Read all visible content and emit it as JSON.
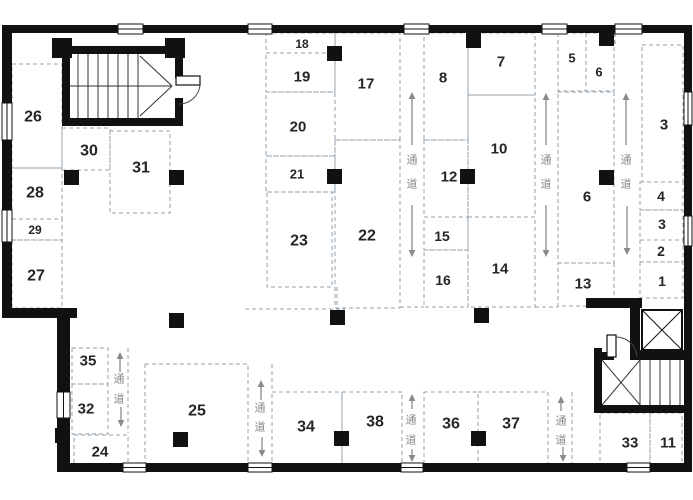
{
  "page": {
    "kind": "architectural-floor-plan",
    "language": "zh",
    "background": "#ffffff"
  },
  "plan": {
    "canvas": {
      "w": 693,
      "h": 500
    },
    "colors": {
      "wall": "#111111",
      "dash": "#93a1ad",
      "label": "#262626",
      "corridor_text": "#8a8a8a",
      "arrow": "#8a8a8a",
      "stair_line": "#333333",
      "bg": "#ffffff"
    },
    "corridor_label": "通道",
    "rooms": [
      {
        "name": "room-26",
        "label": "26",
        "box": [
          12,
          64,
          50,
          104
        ],
        "lp": [
          33,
          117
        ],
        "fs": 16
      },
      {
        "name": "room-30",
        "label": "30",
        "box": [
          62,
          128,
          48,
          42
        ],
        "lp": [
          89,
          151
        ],
        "fs": 16
      },
      {
        "name": "room-31",
        "label": "31",
        "box": [
          110,
          131,
          60,
          82
        ],
        "lp": [
          141,
          168
        ],
        "fs": 16
      },
      {
        "name": "room-28",
        "label": "28",
        "box": [
          12,
          168,
          50,
          51
        ],
        "lp": [
          35,
          193
        ],
        "fs": 16
      },
      {
        "name": "room-29",
        "label": "29",
        "box": [
          12,
          219,
          50,
          21
        ],
        "lp": [
          35,
          230
        ],
        "fs": 12
      },
      {
        "name": "room-27",
        "label": "27",
        "box": [
          12,
          240,
          50,
          68
        ],
        "lp": [
          36,
          276
        ],
        "fs": 16
      },
      {
        "name": "room-18",
        "label": "18",
        "box": [
          266,
          33,
          69,
          20
        ],
        "lp": [
          302,
          44
        ],
        "fs": 12
      },
      {
        "name": "room-19",
        "label": "19",
        "box": [
          266,
          53,
          69,
          39
        ],
        "lp": [
          302,
          77
        ],
        "fs": 15
      },
      {
        "name": "room-20",
        "label": "20",
        "box": [
          266,
          92,
          69,
          64
        ],
        "lp": [
          298,
          127
        ],
        "fs": 15
      },
      {
        "name": "room-21",
        "label": "21",
        "box": [
          266,
          156,
          69,
          36
        ],
        "lp": [
          297,
          174
        ],
        "fs": 13
      },
      {
        "name": "room-23",
        "label": "23",
        "box": [
          267,
          192,
          65,
          95
        ],
        "lp": [
          299,
          241
        ],
        "fs": 16
      },
      {
        "name": "room-17",
        "label": "17",
        "box": [
          335,
          33,
          65,
          107
        ],
        "lp": [
          366,
          84
        ],
        "fs": 15
      },
      {
        "name": "room-22",
        "label": "22",
        "box": [
          335,
          140,
          65,
          168
        ],
        "lp": [
          367,
          236
        ],
        "fs": 16
      },
      {
        "name": "room-8",
        "label": "8",
        "box": [
          424,
          33,
          44,
          107
        ],
        "lp": [
          443,
          78
        ],
        "fs": 15
      },
      {
        "name": "room-12",
        "label": "12",
        "box": [
          424,
          140,
          44,
          77
        ],
        "lp": [
          449,
          177
        ],
        "fs": 15
      },
      {
        "name": "room-15",
        "label": "15",
        "box": [
          424,
          217,
          44,
          33
        ],
        "lp": [
          442,
          236
        ],
        "fs": 14
      },
      {
        "name": "room-16",
        "label": "16",
        "box": [
          424,
          250,
          44,
          57
        ],
        "lp": [
          443,
          280
        ],
        "fs": 14
      },
      {
        "name": "room-7",
        "label": "7",
        "box": [
          468,
          33,
          67,
          62
        ],
        "lp": [
          501,
          62
        ],
        "fs": 15
      },
      {
        "name": "room-10",
        "label": "10",
        "box": [
          468,
          95,
          67,
          122
        ],
        "lp": [
          499,
          149
        ],
        "fs": 15
      },
      {
        "name": "room-14",
        "label": "14",
        "box": [
          468,
          217,
          67,
          90
        ],
        "lp": [
          500,
          269
        ],
        "fs": 15
      },
      {
        "name": "room-5",
        "label": "5",
        "box": [
          558,
          33,
          28,
          58
        ],
        "lp": [
          572,
          58
        ],
        "fs": 13
      },
      {
        "name": "room-6-small",
        "label": "6",
        "box": [
          586,
          33,
          28,
          58
        ],
        "lp": [
          599,
          72
        ],
        "fs": 13
      },
      {
        "name": "room-6",
        "label": "6",
        "box": [
          558,
          92,
          56,
          171
        ],
        "lp": [
          587,
          197
        ],
        "fs": 15
      },
      {
        "name": "room-13",
        "label": "13",
        "box": [
          558,
          263,
          56,
          43
        ],
        "lp": [
          583,
          284
        ],
        "fs": 15
      },
      {
        "name": "room-3",
        "label": "3",
        "box": [
          642,
          45,
          41,
          137
        ],
        "lp": [
          664,
          125
        ],
        "fs": 15
      },
      {
        "name": "room-4",
        "label": "4",
        "box": [
          640,
          182,
          43,
          28
        ],
        "lp": [
          661,
          196
        ],
        "fs": 14
      },
      {
        "name": "room-3-small",
        "label": "3",
        "box": [
          640,
          210,
          43,
          30
        ],
        "lp": [
          662,
          224
        ],
        "fs": 14
      },
      {
        "name": "room-2",
        "label": "2",
        "box": [
          640,
          240,
          43,
          22
        ],
        "lp": [
          661,
          251
        ],
        "fs": 14
      },
      {
        "name": "room-1",
        "label": "1",
        "box": [
          640,
          262,
          43,
          36
        ],
        "lp": [
          662,
          281
        ],
        "fs": 14
      },
      {
        "name": "room-35",
        "label": "35",
        "box": [
          72,
          348,
          36,
          36
        ],
        "lp": [
          88,
          361
        ],
        "fs": 15
      },
      {
        "name": "room-32",
        "label": "32",
        "box": [
          72,
          384,
          36,
          50
        ],
        "lp": [
          86,
          409
        ],
        "fs": 15
      },
      {
        "name": "room-24",
        "label": "24",
        "box": [
          74,
          435,
          54,
          30
        ],
        "lp": [
          100,
          452
        ],
        "fs": 15
      },
      {
        "name": "room-25",
        "label": "25",
        "box": [
          145,
          364,
          103,
          102
        ],
        "lp": [
          197,
          411
        ],
        "fs": 16
      },
      {
        "name": "room-34",
        "label": "34",
        "box": [
          272,
          392,
          70,
          73
        ],
        "lp": [
          306,
          427
        ],
        "fs": 16
      },
      {
        "name": "room-38",
        "label": "38",
        "box": [
          342,
          392,
          60,
          73
        ],
        "lp": [
          375,
          422
        ],
        "fs": 16
      },
      {
        "name": "room-36",
        "label": "36",
        "box": [
          424,
          392,
          54,
          73
        ],
        "lp": [
          451,
          424
        ],
        "fs": 16
      },
      {
        "name": "room-37",
        "label": "37",
        "box": [
          478,
          392,
          70,
          73
        ],
        "lp": [
          511,
          424
        ],
        "fs": 16
      },
      {
        "name": "room-33",
        "label": "33",
        "box": [
          600,
          413,
          50,
          51
        ],
        "lp": [
          630,
          443
        ],
        "fs": 15
      },
      {
        "name": "room-11",
        "label": "11",
        "box": [
          650,
          413,
          32,
          51
        ],
        "lp": [
          668,
          443
        ],
        "fs": 15
      }
    ],
    "corridors": [
      {
        "name": "corridor-upper-1",
        "label": "通道",
        "chars": [
          [
            412,
            160
          ],
          [
            412,
            184
          ]
        ],
        "up": [
          412,
          92,
          145
        ],
        "down": [
          412,
          205,
          257
        ],
        "lines": []
      },
      {
        "name": "corridor-upper-2",
        "label": "通道",
        "chars": [
          [
            546,
            160
          ],
          [
            546,
            184
          ]
        ],
        "up": [
          546,
          93,
          145
        ],
        "down": [
          546,
          205,
          257
        ],
        "lines": []
      },
      {
        "name": "corridor-upper-3",
        "label": "通道",
        "chars": [
          [
            626,
            160
          ],
          [
            626,
            184
          ]
        ],
        "up": [
          626,
          93,
          145
        ],
        "down": [
          627,
          206,
          255
        ],
        "lines": [
          [
            615,
            33,
            45
          ]
        ]
      },
      {
        "name": "corridor-lower-1",
        "label": "通道",
        "chars": [
          [
            119,
            379
          ],
          [
            119,
            399
          ]
        ],
        "up": [
          120,
          352,
          372
        ],
        "down": [
          121,
          407,
          427
        ],
        "lines": [
          [
            128,
            348,
            433
          ]
        ]
      },
      {
        "name": "corridor-lower-2",
        "label": "通道",
        "chars": [
          [
            260,
            408
          ],
          [
            260,
            427
          ]
        ],
        "up": [
          261,
          380,
          400
        ],
        "down": [
          262,
          437,
          457
        ],
        "lines": [
          [
            272,
            364,
            392
          ]
        ]
      },
      {
        "name": "corridor-lower-3",
        "label": "通道",
        "chars": [
          [
            411,
            420
          ],
          [
            411,
            440
          ]
        ],
        "up": [
          412,
          394,
          409
        ],
        "down": [
          412,
          449,
          462
        ],
        "lines": []
      },
      {
        "name": "corridor-lower-4",
        "label": "通道",
        "chars": [
          [
            561,
            421
          ],
          [
            561,
            440
          ]
        ],
        "up": [
          561,
          396,
          411
        ],
        "down": [
          563,
          447,
          462
        ],
        "lines": [
          [
            572,
            392,
            463
          ]
        ]
      }
    ],
    "extra_dashes": [
      [
        245,
        309,
        345,
        309
      ],
      [
        400,
        307,
        424,
        307
      ],
      [
        535,
        307,
        558,
        307
      ],
      [
        337,
        287,
        337,
        309
      ]
    ],
    "walls": [
      {
        "n": "wall-top",
        "r": [
          2,
          25,
          688,
          8
        ]
      },
      {
        "n": "wall-left",
        "r": [
          2,
          25,
          10,
          291
        ]
      },
      {
        "n": "wall-step",
        "r": [
          2,
          308,
          75,
          10
        ]
      },
      {
        "n": "wall-left-lower",
        "r": [
          57,
          318,
          13,
          153
        ]
      },
      {
        "n": "wall-bottom",
        "r": [
          57,
          463,
          633,
          9
        ]
      },
      {
        "n": "wall-right",
        "r": [
          684,
          25,
          8,
          447
        ]
      },
      {
        "n": "stair-tl-wall-top",
        "r": [
          62,
          46,
          121,
          8
        ]
      },
      {
        "n": "stair-tl-wall-bottom",
        "r": [
          62,
          118,
          121,
          8
        ]
      },
      {
        "n": "stair-tl-wall-left",
        "r": [
          62,
          46,
          8,
          80
        ]
      },
      {
        "n": "stair-tl-wall-right-upper",
        "r": [
          175,
          46,
          8,
          32
        ]
      },
      {
        "n": "stair-tl-wall-right-lower",
        "r": [
          175,
          98,
          8,
          28
        ]
      },
      {
        "n": "stair-tl-post-left",
        "r": [
          52,
          38,
          20,
          20
        ]
      },
      {
        "n": "stair-tl-post-right",
        "r": [
          165,
          38,
          20,
          20
        ]
      },
      {
        "n": "wall-elevator-stub",
        "r": [
          586,
          298,
          56,
          10
        ]
      },
      {
        "n": "wall-elevator-left",
        "r": [
          630,
          298,
          10,
          62
        ]
      },
      {
        "n": "wall-under-elevator",
        "r": [
          630,
          350,
          60,
          10
        ]
      },
      {
        "n": "wall-stair-br-left",
        "r": [
          594,
          348,
          8,
          65
        ]
      },
      {
        "n": "wall-stair-br-top",
        "r": [
          602,
          352,
          12,
          8
        ]
      },
      {
        "n": "wall-stair-br-bottom",
        "r": [
          594,
          405,
          96,
          8
        ]
      }
    ],
    "windows": [
      {
        "o": "h",
        "r": [
          118,
          24,
          25,
          10
        ]
      },
      {
        "o": "h",
        "r": [
          248,
          24,
          24,
          10
        ]
      },
      {
        "o": "h",
        "r": [
          404,
          24,
          25,
          10
        ]
      },
      {
        "o": "h",
        "r": [
          542,
          24,
          25,
          10
        ]
      },
      {
        "o": "h",
        "r": [
          615,
          24,
          27,
          10
        ]
      },
      {
        "o": "h",
        "r": [
          123,
          463,
          23,
          9
        ]
      },
      {
        "o": "h",
        "r": [
          248,
          463,
          24,
          9
        ]
      },
      {
        "o": "h",
        "r": [
          401,
          463,
          22,
          9
        ]
      },
      {
        "o": "h",
        "r": [
          627,
          463,
          23,
          9
        ]
      },
      {
        "o": "v",
        "r": [
          2,
          103,
          10,
          37
        ]
      },
      {
        "o": "v",
        "r": [
          2,
          210,
          10,
          32
        ]
      },
      {
        "o": "v",
        "r": [
          57,
          392,
          13,
          26
        ]
      },
      {
        "o": "v",
        "r": [
          684,
          92,
          8,
          33
        ]
      },
      {
        "o": "v",
        "r": [
          684,
          216,
          8,
          30
        ]
      }
    ],
    "columns": [
      [
        327,
        46
      ],
      [
        466,
        33
      ],
      [
        599,
        31
      ],
      [
        64,
        170
      ],
      [
        169,
        170
      ],
      [
        327,
        169
      ],
      [
        460,
        169
      ],
      [
        599,
        170
      ],
      [
        169,
        313
      ],
      [
        330,
        310
      ],
      [
        474,
        308
      ],
      [
        55,
        428
      ],
      [
        173,
        432
      ],
      [
        334,
        431
      ],
      [
        471,
        431
      ]
    ],
    "column_size": 15,
    "stair_top_left": {
      "tread_xs": [
        78,
        88,
        98,
        108,
        118,
        128,
        138
      ],
      "tread_y1": 54,
      "tread_y2": 118,
      "mid_line": [
        70,
        86,
        172,
        86
      ],
      "diagonals": [
        [
          140,
          56,
          172,
          86
        ],
        [
          140,
          116,
          172,
          86
        ]
      ]
    },
    "stair_bottom_right": {
      "tread_xs": [
        640,
        650,
        660,
        670,
        680
      ],
      "tread_y1": 360,
      "tread_y2": 405,
      "cross": [
        [
          602,
          360,
          640,
          405
        ],
        [
          602,
          405,
          640,
          360
        ]
      ]
    },
    "elevator": {
      "name": "elevator-shaft",
      "box": [
        642,
        310,
        40,
        40
      ]
    },
    "doors": [
      {
        "name": "door-stair-top-left",
        "leaf": [
          176,
          76,
          24,
          9
        ],
        "arc": "M 200,85 A 21,21 0 0 1 179,104"
      },
      {
        "name": "door-stair-bottom-right",
        "leaf": [
          607,
          335,
          9,
          22
        ],
        "arc": "M 616,337 A 21,21 0 0 1 637,357"
      }
    ]
  }
}
